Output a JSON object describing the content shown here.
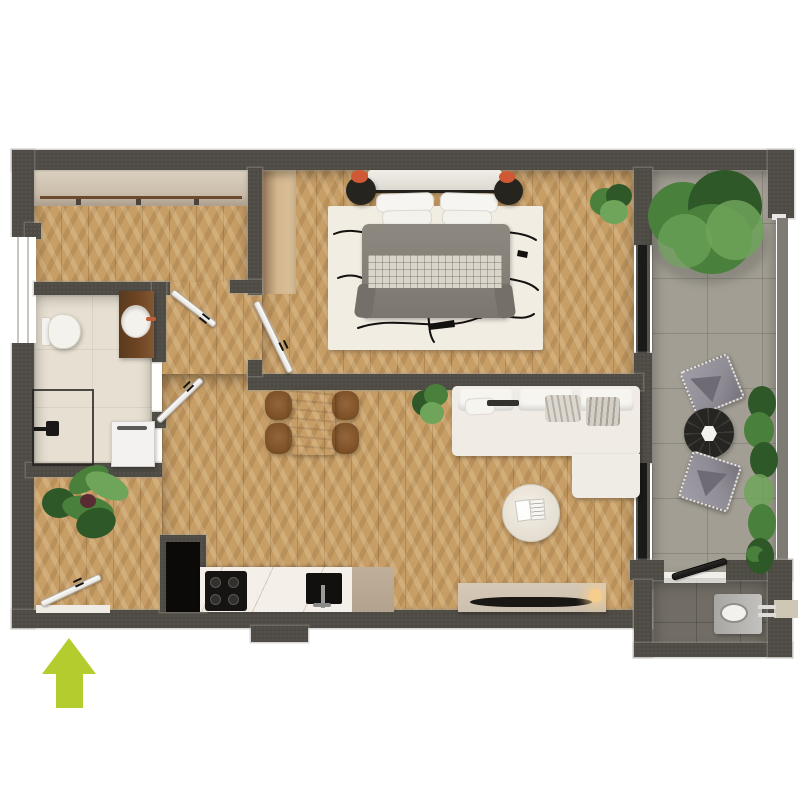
{
  "plan": {
    "kind": "apartment-floor-plan-3d-render",
    "view": "top-down",
    "entrance_marker": "lime-green up arrow at bottom-left outside the wall",
    "rooms": [
      {
        "id": "hall",
        "name": "entry hall with open wardrobe"
      },
      {
        "id": "bathroom",
        "name": "bathroom with shower, toilet, vanity, washing machine"
      },
      {
        "id": "bedroom",
        "name": "bedroom with double bed, nightstands, wardrobe niche, rug"
      },
      {
        "id": "living",
        "name": "open living / dining / kitchen"
      },
      {
        "id": "balcony",
        "name": "balcony terrace with tree, lounge chairs, round table, planters"
      },
      {
        "id": "utility",
        "name": "outdoor utility room with wall-hung fixture"
      }
    ],
    "furniture": {
      "bedroom": [
        "double-bed",
        "headboard-bench",
        "pillows",
        "gray-duvet",
        "checkered-blanket",
        "black-round-nightstand-left",
        "black-round-nightstand-right",
        "abstract-line-rug",
        "corner-plant"
      ],
      "bathroom": [
        "toilet",
        "wood-vanity-with-round-sink",
        "glass-shower",
        "shower-fixture",
        "washing-machine"
      ],
      "kitchen": [
        "tall-black-unit",
        "marble-counter",
        "black-cooktop",
        "black-sink-with-faucet",
        "beige-cabinet"
      ],
      "living": [
        "l-shaped-white-sofa",
        "round-coffee-table-with-book",
        "tv-sideboard",
        "flat-tv",
        "table-lamp",
        "plant"
      ],
      "dining": [
        "wood-dining-table",
        "four-brown-chairs"
      ],
      "entry": [
        "large-leaf-plant",
        "entrance-door"
      ],
      "balcony": [
        "large-tree",
        "lounge-chair-top",
        "lounge-chair-bottom",
        "black-round-side-table",
        "hedge-planters",
        "utility-fixture",
        "outside-step"
      ]
    },
    "doors": [
      "hall-door",
      "bathroom-door",
      "bedroom-door",
      "entrance-door",
      "utility-door"
    ],
    "windows": [
      "left-wall-window",
      "balcony-glass-upper",
      "balcony-glass-lower"
    ]
  },
  "colors": {
    "wall": "#4e4a44",
    "wallEdge": "#928e86",
    "railGray": "#7e7a74",
    "woodBase": "#c79e66",
    "bathTile": "#e7e0d2",
    "balconyTile": "#a29e94",
    "wcTile": "#716d65",
    "rug": "#f2ede2",
    "arrow": "#b5cc2f",
    "doorLeaf": "#f6f4f0",
    "glass": "#1a1a18",
    "sofa": "#f0ece5",
    "duvet": "#857f77",
    "checker": "#d9d5ca",
    "marble": "#f4f0e9",
    "beigeCabinet": "#b3a28d",
    "sideboard": "#ccbfad",
    "tv": "#1a1815",
    "lampGlow": "#f6cd8d",
    "plantDark": "#2f5829",
    "plantMid": "#49803b",
    "plantLight": "#6fa55b",
    "nightstand": "#26241f",
    "nightstandAccent": "#cf5835",
    "vanity": "#6f4524",
    "fixture": "#f4f2ec",
    "chairBrown": "#7c5026",
    "diningTable": "#c2b29c",
    "outdoorChair": "#8f8c95",
    "outdoorTable": "#262522",
    "wardrobeHi": "#ddd2c2",
    "wardrobeLo": "#c3b4a1",
    "nicheHi": "#d3b68c",
    "nicheLo": "#96765a",
    "step": "#cfc7b5",
    "threshold": "#efece6"
  }
}
